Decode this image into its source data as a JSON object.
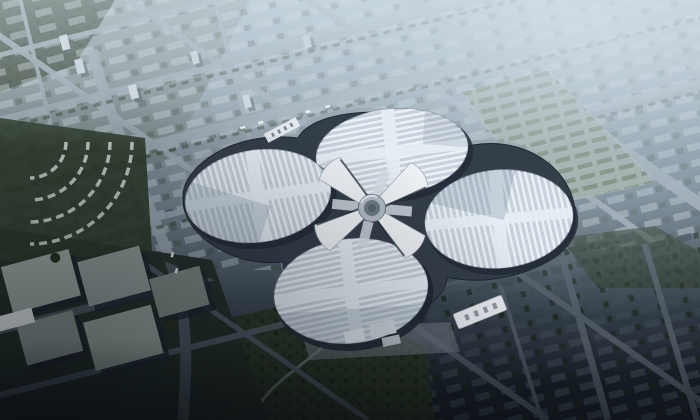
{
  "image": {
    "kind": "aerial architectural rendering",
    "visible_text": "none",
    "description": "Hazy aerial rendering of a vast four-petal clover-shaped exhibition complex at the center of a gridded city: four oval halls with bright white ribbed roofs and light cross bands surround a circular hub joined by white X-shaped connectors; pale avenues and tree-lined residential blocks fill the hazy upper half, a green tree-row parking field lies northeast, curved terrace housing and flat-roof industrial blocks lie west, and dark shadowed city blocks and parks fill the lower third."
  },
  "scene": {
    "complex": {
      "halls": [
        "north hall",
        "west hall",
        "east hall",
        "south hall"
      ],
      "hub": "central circular plaza with four white connector arms",
      "roof_finish": "white ribbed stripes with light cross bands",
      "extras": [
        "southeast entrance canopy with roof vents",
        "northwest bus strip",
        "south service plaza"
      ]
    },
    "districts": [
      "top-left residential grid with tree rows",
      "top-right hazy city grid",
      "northeast tree-row parking field",
      "west curved terrace housing",
      "southwest industrial flat-roof blocks",
      "south park with winding path",
      "southeast dark city blocks"
    ],
    "lighting": "daylight haze strongest at upper right, deep shadow toward bottom left"
  },
  "palette": {
    "sky_haze": "#a9bcc9",
    "city_light": "#8b99a4",
    "city_mid": "#6e7d88",
    "ground_dark": "#1a212a",
    "road_light": "#9aa6b0",
    "road_dark": "#4e5862",
    "block_light": "#c8d2d8",
    "block_dark": "#39434d",
    "tree_dark": "#26311f",
    "tree_mid": "#2b3726",
    "parking_green": "#5b6e4e",
    "parking_ground": "#93a096",
    "roof_base": "#c7d2dc",
    "roof_stripe": "#f4f8fb",
    "roof_band": "#e6edf3",
    "roof_shadow": "#718499",
    "podium_dark": "#343e49",
    "podium_light": "#97a1aa",
    "hub_arm": "#eef2f6",
    "hub_core": "#6f7a85",
    "canopy_white": "#e9edf1"
  }
}
